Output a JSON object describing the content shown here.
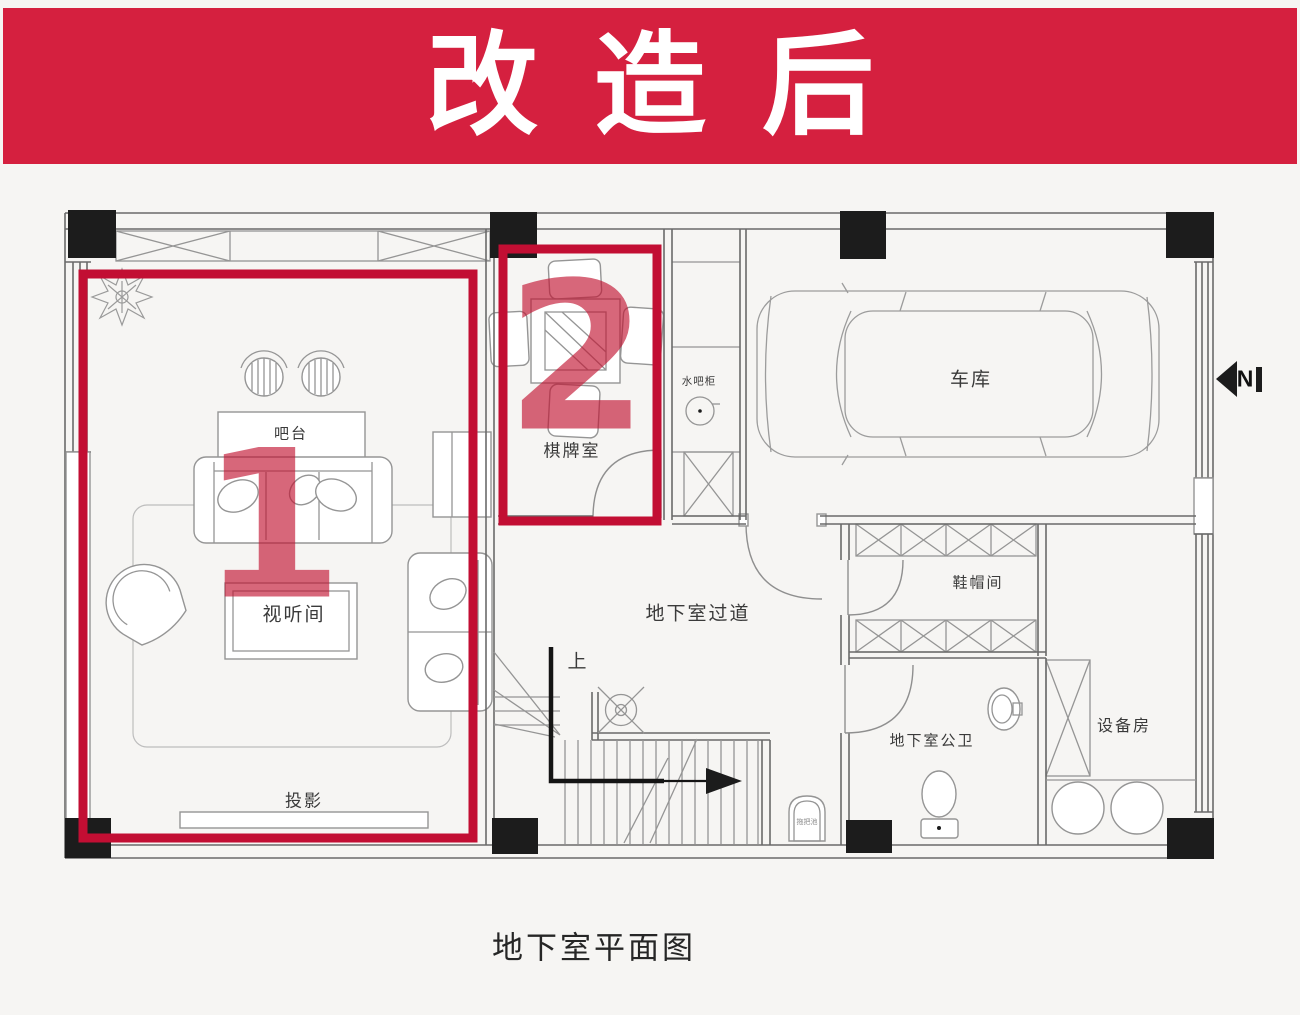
{
  "banner": {
    "title": "改造后"
  },
  "caption": "地下室平面图",
  "north_label": "N",
  "zone_markers": {
    "zone1": "1",
    "zone2": "2"
  },
  "room_labels": {
    "bar_counter": "吧台",
    "av_room": "视听间",
    "projection": "投影",
    "chess_room": "棋牌室",
    "water_bar_cabinet": "水吧柜",
    "garage": "车库",
    "basement_corridor": "地下室过道",
    "stairs_up": "上",
    "cloakroom": "鞋帽间",
    "basement_bathroom": "地下室公卫",
    "equipment_room": "设备房",
    "mop_basin": "拖把池"
  },
  "colors": {
    "banner_red": "#d5203f",
    "highlight_red": "#c20e33",
    "numeral_red": "#c21230",
    "wall_black": "#1c1c1c",
    "line_gray": "#8a8a8a"
  }
}
